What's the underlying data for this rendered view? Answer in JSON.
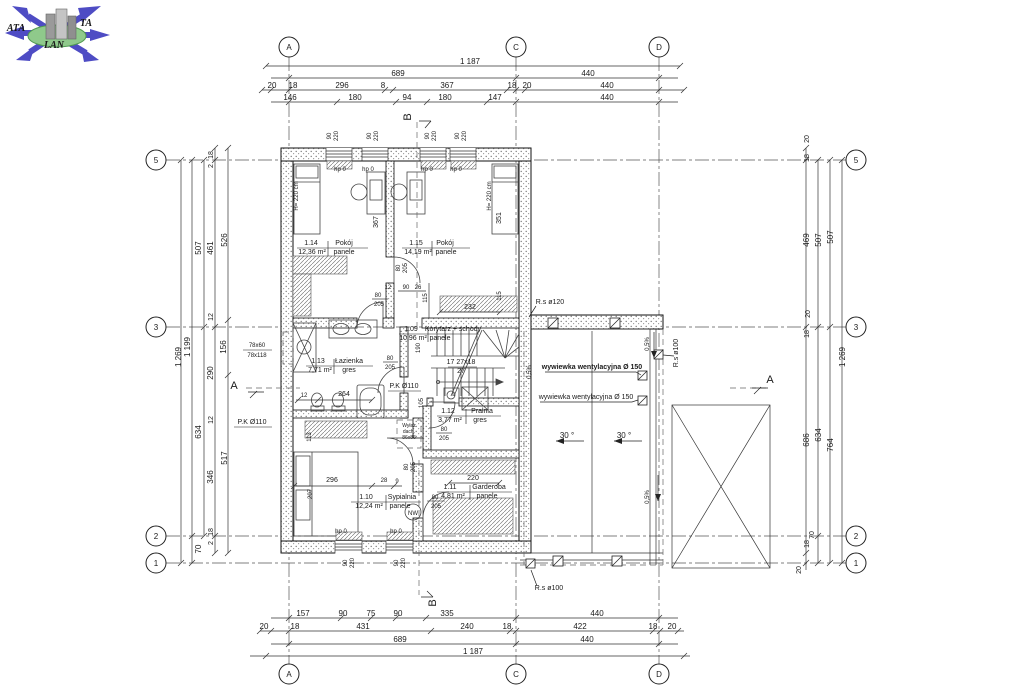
{
  "colors": {
    "line": "#1a1a1a",
    "logo_blue": "#4e4cc4",
    "logo_green": "#8fc98b"
  },
  "logo": {
    "ata": "ATA",
    "ta": "TA",
    "lan": "LAN"
  },
  "axis_bubbles": {
    "a": "A",
    "b": "B",
    "c": "C",
    "d": "D",
    "n1": "1",
    "n2": "2",
    "n3": "3",
    "n5": "5"
  },
  "dims": {
    "top": {
      "total": "1 187",
      "row2": [
        "689",
        "440"
      ],
      "row3": [
        "20",
        "18",
        "296",
        "8",
        "367",
        "18",
        "20",
        "440"
      ],
      "row4": [
        "146",
        "180",
        "94",
        "180",
        "147",
        "440"
      ]
    },
    "bottom": {
      "row1": [
        "157",
        "90",
        "75",
        "90",
        "335",
        "440"
      ],
      "row2": [
        "20",
        "18",
        "431",
        "240",
        "18",
        "422",
        "18",
        "20"
      ],
      "row3": [
        "689",
        "440"
      ],
      "total": "1 187"
    },
    "left": {
      "total": "1 269",
      "col2": [
        "1 199",
        "70"
      ],
      "col3": [
        "507",
        "634"
      ],
      "col4": [
        "18",
        "2",
        "461",
        "12",
        "290",
        "12",
        "346",
        "18",
        "2"
      ],
      "col5": [
        "526",
        "156",
        "517"
      ]
    },
    "right": {
      "col1": [
        "20",
        "18",
        "469",
        "20",
        "18",
        "686",
        "18",
        "20"
      ],
      "col2": [
        "507",
        "634",
        "70"
      ],
      "col3": [
        "507",
        "764"
      ],
      "total": "1 269"
    }
  },
  "rooms": [
    {
      "number": "1.14",
      "name": "Pokój",
      "area": "12,36 m²",
      "floor": "panele"
    },
    {
      "number": "1.15",
      "name": "Pokój",
      "area": "14,19 m²",
      "floor": "panele"
    },
    {
      "number": "1.13",
      "name": "Łazienka",
      "area": "7,71 m²",
      "floor": "gres"
    },
    {
      "number": "1.09",
      "name": "Korytarz + schody",
      "area": "10,96 m²",
      "floor": "panele"
    },
    {
      "number": "1.12",
      "name": "Pralnia",
      "area": "3,77 m²",
      "floor": "gres"
    },
    {
      "number": "1.10",
      "name": "Sypialnia",
      "area": "12,24 m²",
      "floor": "panele"
    },
    {
      "number": "1.11",
      "name": "Garderoba",
      "area": "4,81 m²",
      "floor": "panele"
    }
  ],
  "stairs": {
    "line1": "17 27x18",
    "line2": "27"
  },
  "common": {
    "hp0": "hp 0",
    "h220": "H= 220 cm",
    "d80": "80",
    "d205": "205",
    "w90": "90",
    "w220": "220",
    "pk110": "P.K Ø110",
    "rs100": "R.s ø100",
    "slope": "0,5%",
    "deg30": "30 °",
    "wyw": "wywiewka wentylacyjna  Ø 150"
  },
  "labels": {
    "rs120": "R.s ø120",
    "roof_win_top": "78x60",
    "roof_win_bottom": "78x118",
    "nw": "NW",
    "wylaz1": "Wyłaz",
    "wylaz2": "dach.",
    "wylaz3": "86x86",
    "d367": "367",
    "d351": "351",
    "d232": "232",
    "d115": "115",
    "d26": "26",
    "d12": "12",
    "d264": "264",
    "d113": "113",
    "d296": "296",
    "d28": "28",
    "d9": "9",
    "d207": "207",
    "d190": "190",
    "d105": "105",
    "d220": "220"
  }
}
